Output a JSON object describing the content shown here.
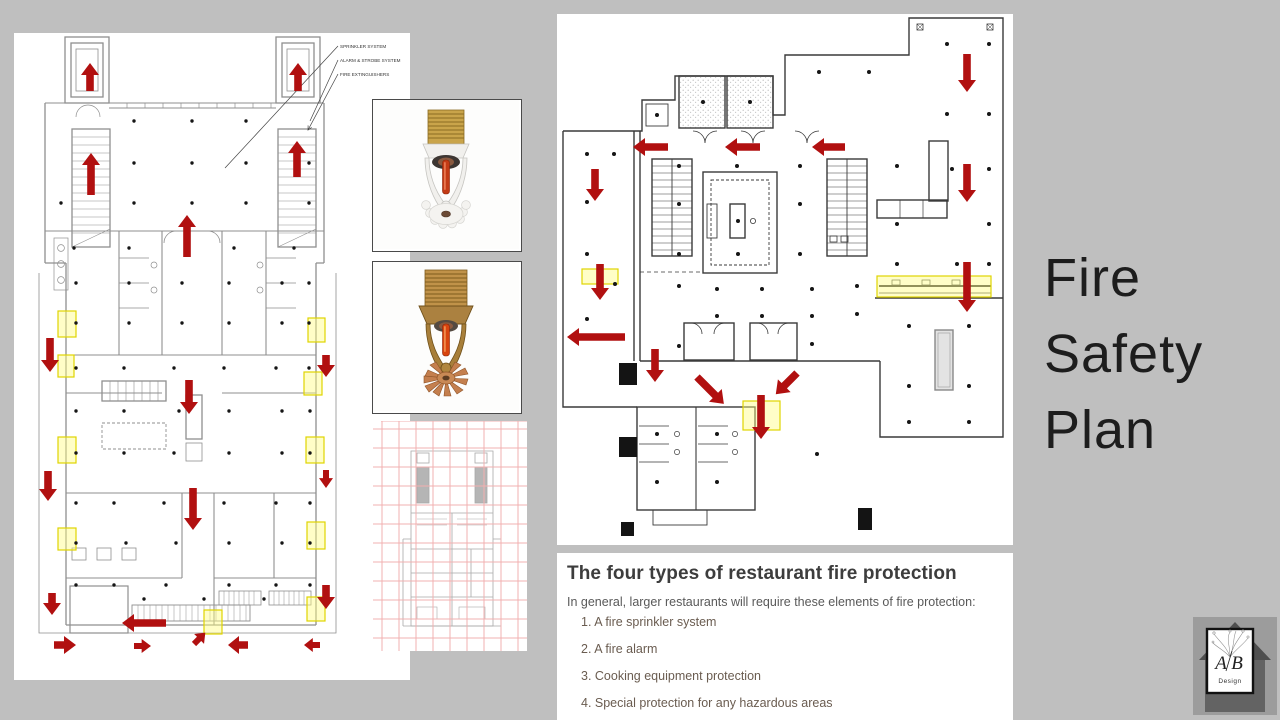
{
  "slide": {
    "background": "#bfbfbf"
  },
  "title": {
    "lines": [
      "Fire",
      "Safety",
      "Plan"
    ]
  },
  "floor_plan_left": {
    "annotations": [
      {
        "label": "SPRINKLER SYSTEM"
      },
      {
        "label": "ALARM & STROBE SYSTEM"
      },
      {
        "label": "FIRE EXTINGUISHERS"
      }
    ]
  },
  "protection_box": {
    "title": "The four types of restaurant fire protection",
    "intro": "In general, larger restaurants will require these elements of fire protection:",
    "items": [
      "1. A fire sprinkler system",
      "2. A fire alarm",
      "3. Cooking equipment protection",
      "4. Special protection for any hazardous areas"
    ]
  },
  "logo": {
    "monogram_left": "A",
    "monogram_right": "B",
    "subtitle": "Design"
  },
  "colors": {
    "arrow_red": "#b11010",
    "highlight_yellow_fill": "rgba(255,252,130,0.45)",
    "highlight_yellow_stroke": "#e0d400",
    "background": "#bfbfbf",
    "plan1_wall": "#8f8f8f",
    "plan2_wall": "#3a3a3a"
  }
}
